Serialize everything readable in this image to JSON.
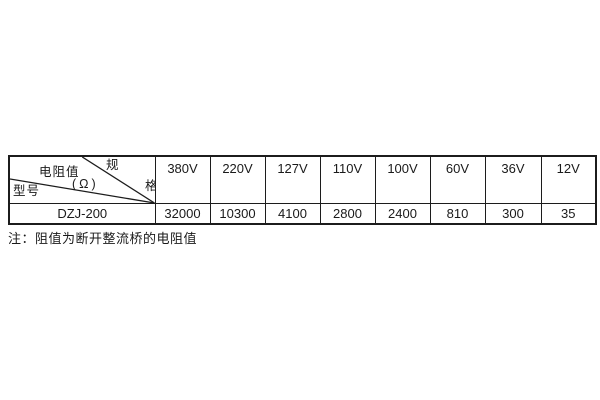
{
  "colors": {
    "background": "#ffffff",
    "border": "#1c1c1c",
    "text": "#1a1a1a"
  },
  "table": {
    "corner": {
      "spec_char_top": "规",
      "spec_char_bottom": "格",
      "spec_label_full": "规格",
      "resistance_label": "电阻值",
      "resistance_unit": "(Ω)",
      "model_label": "型号"
    },
    "columns": [
      "380V",
      "220V",
      "127V",
      "110V",
      "100V",
      "60V",
      "36V",
      "12V"
    ],
    "rows": [
      {
        "model": "DZJ-200",
        "values": [
          "32000",
          "10300",
          "4100",
          "2800",
          "2400",
          "810",
          "300",
          "35"
        ]
      }
    ]
  },
  "note": "注：阻值为断开整流桥的电阻值",
  "chart_data": {
    "type": "table",
    "title": "",
    "corner_labels": {
      "top_right": "规格",
      "middle": "电阻值(Ω)",
      "bottom_left": "型号"
    },
    "columns": [
      "380V",
      "220V",
      "127V",
      "110V",
      "100V",
      "60V",
      "36V",
      "12V"
    ],
    "rows": [
      {
        "model": "DZJ-200",
        "values": [
          32000,
          10300,
          4100,
          2800,
          2400,
          810,
          300,
          35
        ]
      }
    ],
    "note": "注：阻值为断开整流桥的电阻值"
  }
}
